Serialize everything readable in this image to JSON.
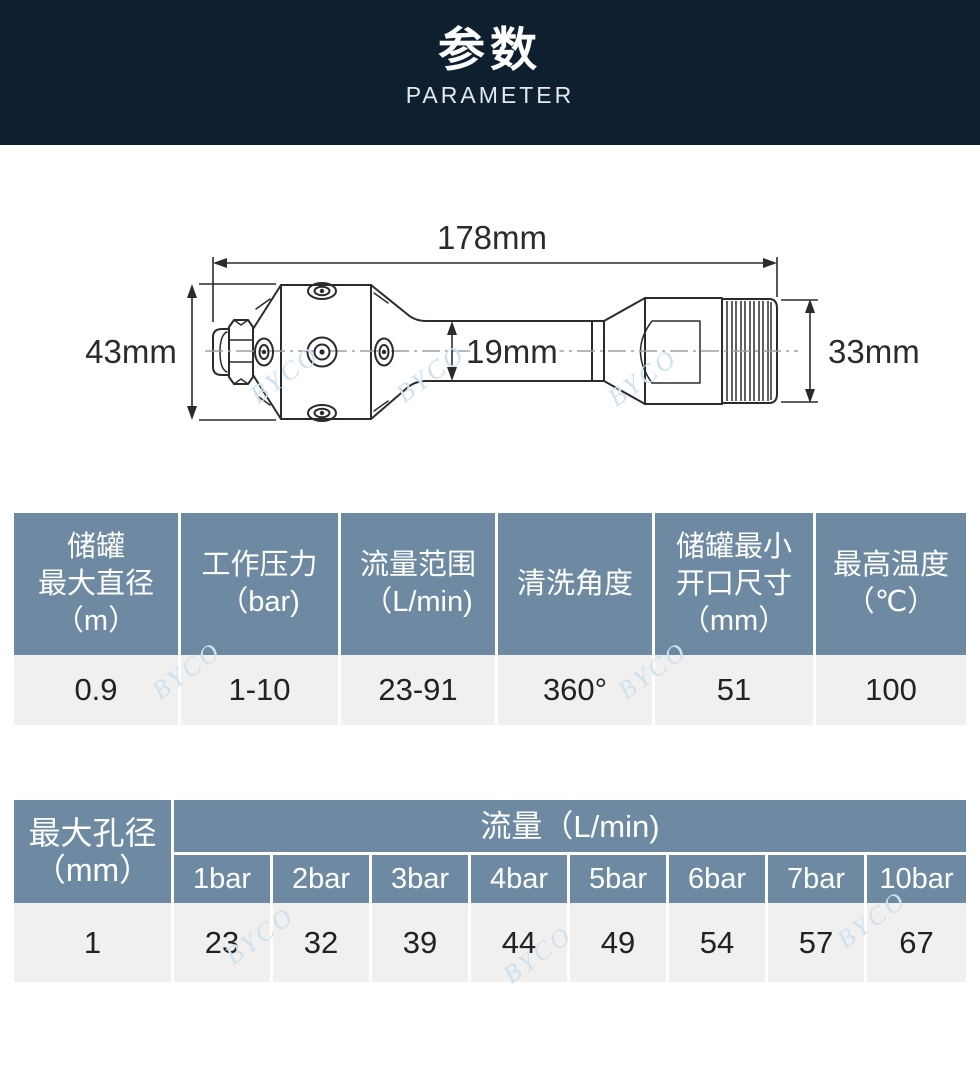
{
  "header": {
    "title_cn": "参数",
    "title_en": "PARAMETER"
  },
  "drawing": {
    "dim_total_length": "178mm",
    "dim_head_diameter": "43mm",
    "dim_neck_diameter": "19mm",
    "dim_thread_diameter": "33mm"
  },
  "watermark": {
    "text": "BYCO"
  },
  "table1": {
    "headers": [
      {
        "lines": [
          "储罐",
          "最大直径",
          "（m）"
        ]
      },
      {
        "lines": [
          "工作压力",
          "（bar)"
        ]
      },
      {
        "lines": [
          "流量范围",
          "（L/min)"
        ]
      },
      {
        "lines": [
          "清洗角度"
        ]
      },
      {
        "lines": [
          "储罐最小",
          "开口尺寸",
          "（mm）"
        ]
      },
      {
        "lines": [
          "最高温度",
          "（℃）"
        ]
      }
    ],
    "values": [
      "0.9",
      "1-10",
      "23-91",
      "360°",
      "51",
      "100"
    ]
  },
  "table2": {
    "row_header": {
      "lines": [
        "最大孔径",
        "（mm）"
      ]
    },
    "group_header": "流量（L/min)",
    "col_headers": [
      "1bar",
      "2bar",
      "3bar",
      "4bar",
      "5bar",
      "6bar",
      "7bar",
      "10bar"
    ],
    "row_value": "1",
    "values": [
      "23",
      "32",
      "39",
      "44",
      "49",
      "54",
      "57",
      "67"
    ]
  },
  "colors": {
    "band_bg": "#0e2030",
    "table_header_bg": "#6d8aa2",
    "table_row_bg": "#f1f0ee"
  }
}
